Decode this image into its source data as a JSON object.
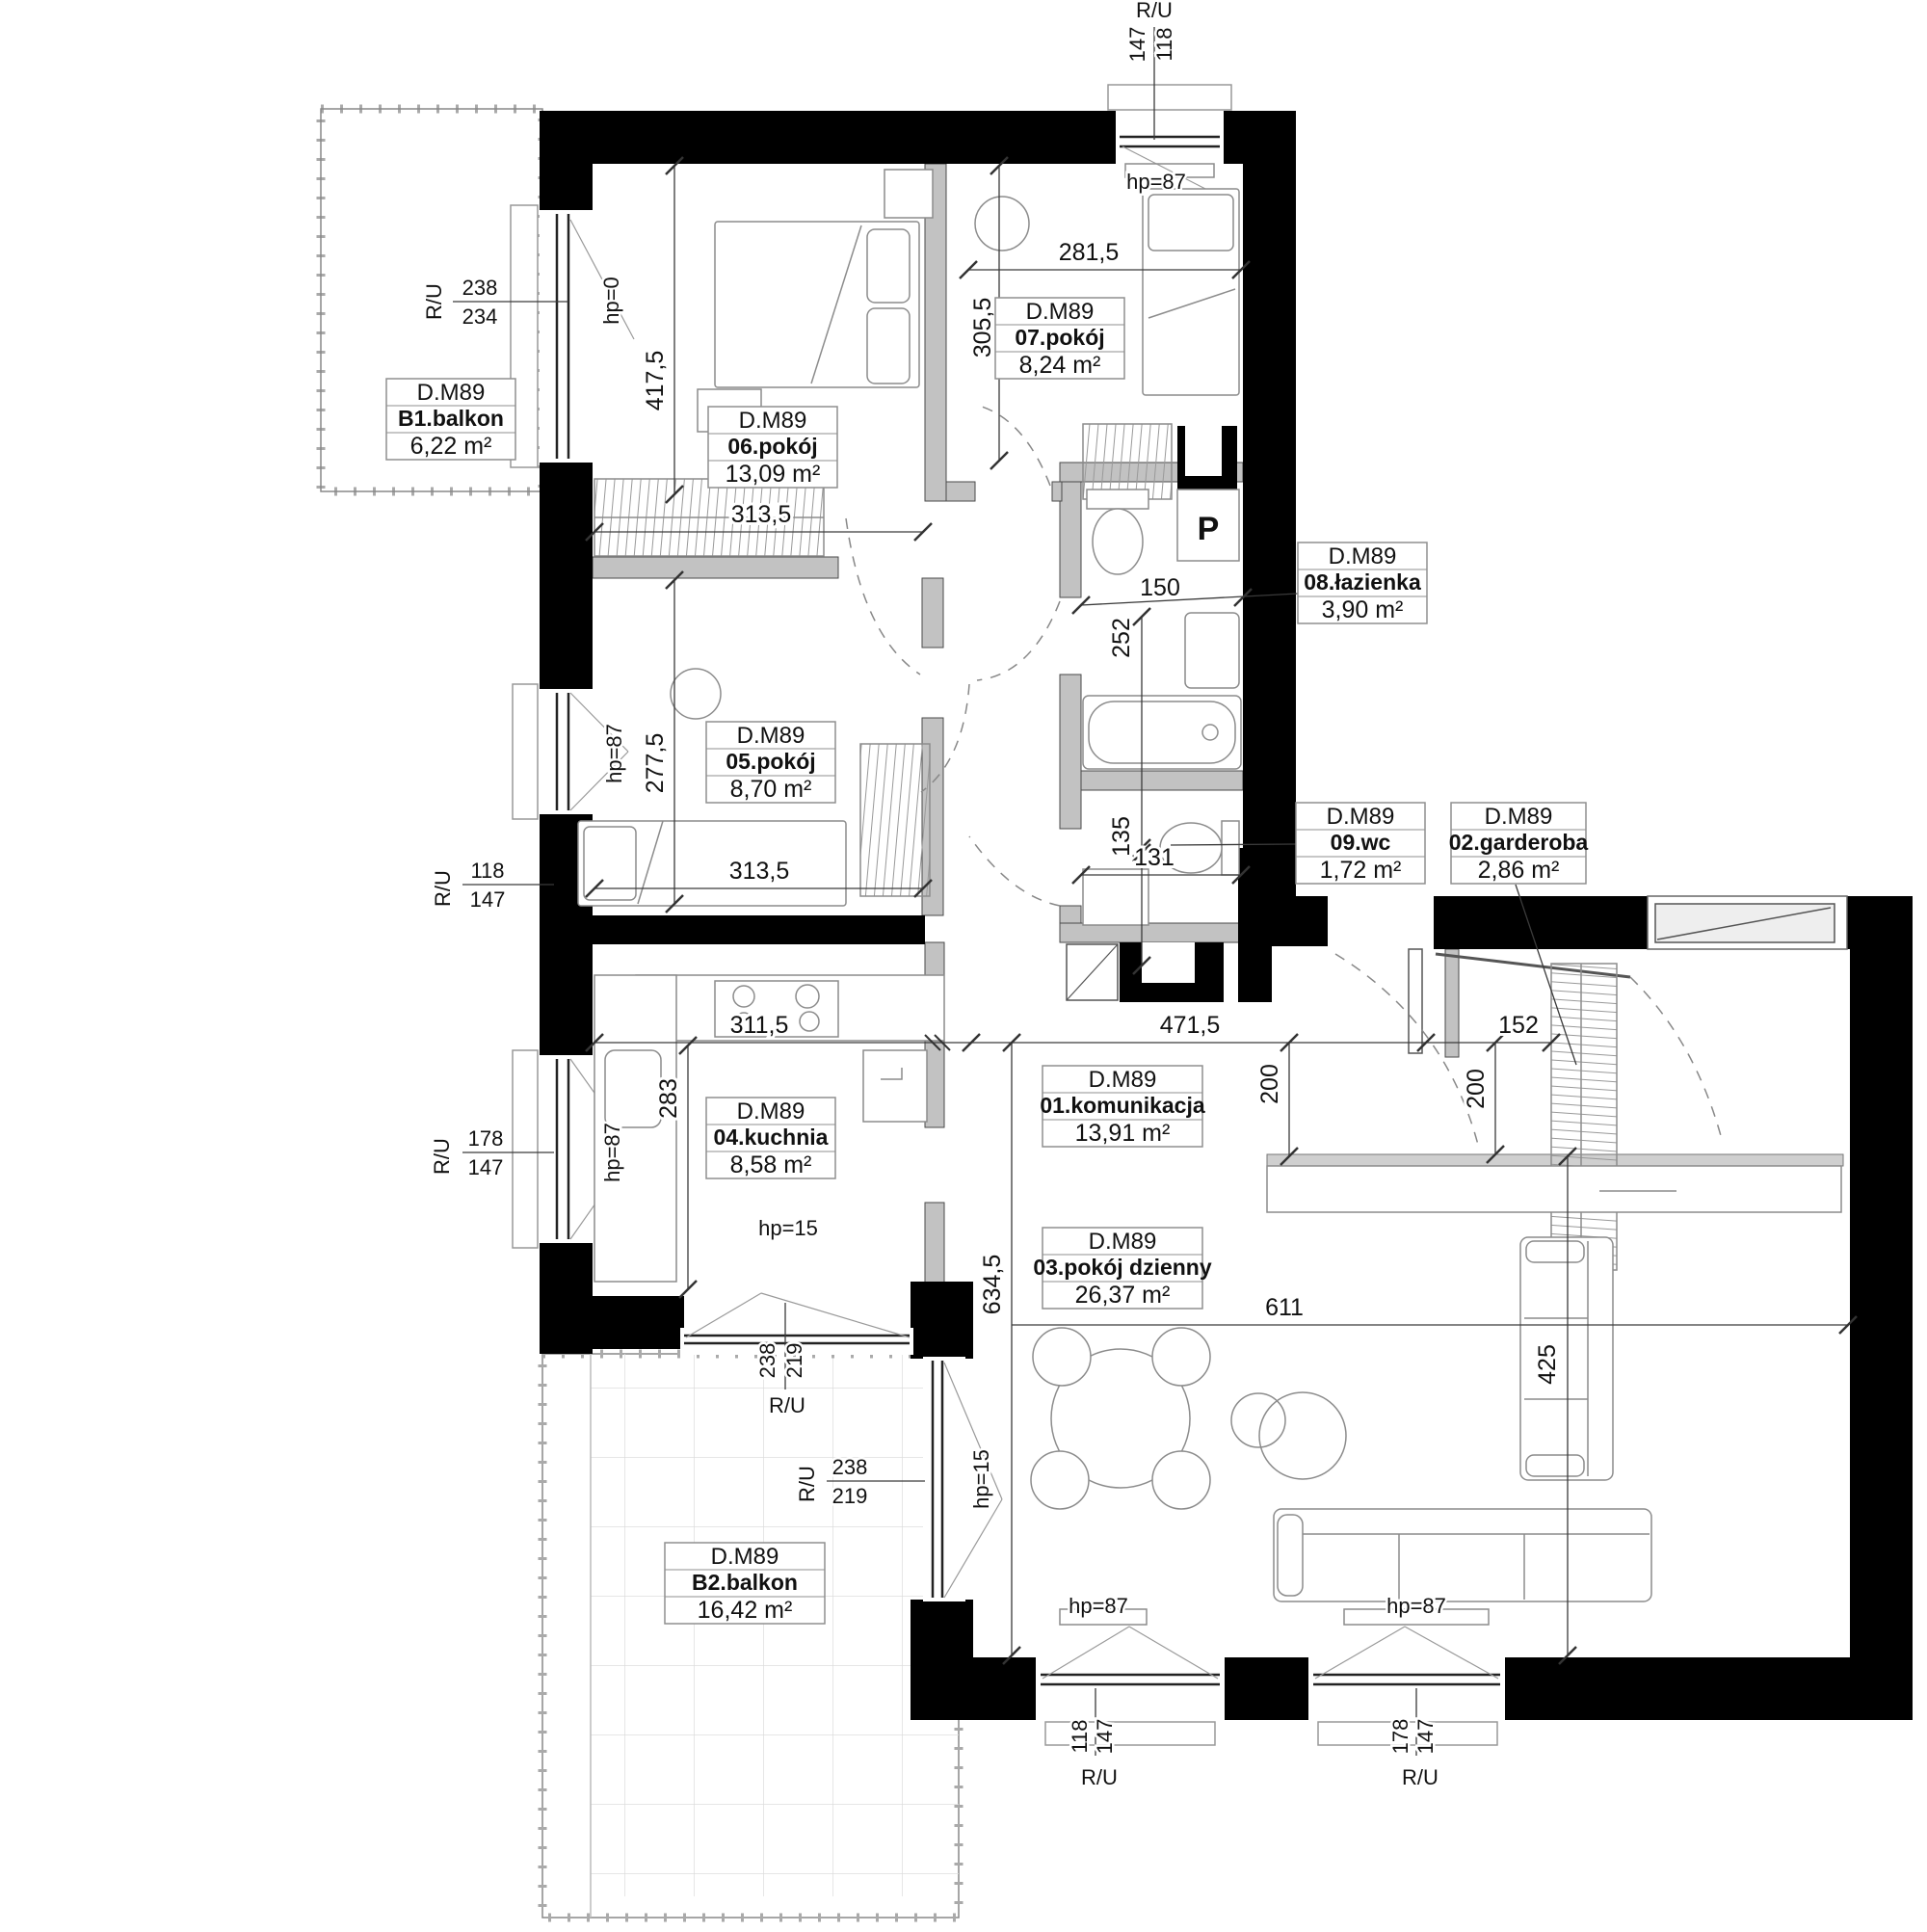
{
  "unit_code": "D.M89",
  "rooms": {
    "komunikacja": {
      "unit": "D.M89",
      "name": "01.komunikacja",
      "area": "13,91 m²"
    },
    "garderoba": {
      "unit": "D.M89",
      "name": "02.garderoba",
      "area": "2,86 m²"
    },
    "pokoj_dzienny": {
      "unit": "D.M89",
      "name": "03.pokój dzienny",
      "area": "26,37 m²"
    },
    "kuchnia": {
      "unit": "D.M89",
      "name": "04.kuchnia",
      "area": "8,58 m²"
    },
    "pokoj05": {
      "unit": "D.M89",
      "name": "05.pokój",
      "area": "8,70 m²"
    },
    "pokoj06": {
      "unit": "D.M89",
      "name": "06.pokój",
      "area": "13,09 m²"
    },
    "pokoj07": {
      "unit": "D.M89",
      "name": "07.pokój",
      "area": "8,24 m²"
    },
    "lazienka": {
      "unit": "D.M89",
      "name": "08.łazienka",
      "area": "3,90 m²"
    },
    "wc": {
      "unit": "D.M89",
      "name": "09.wc",
      "area": "1,72 m²"
    },
    "balkon1": {
      "unit": "D.M89",
      "name": "B1.balkon",
      "area": "6,22 m²"
    },
    "balkon2": {
      "unit": "D.M89",
      "name": "B2.balkon",
      "area": "16,42 m²"
    }
  },
  "dimensions": {
    "w281": "281,5",
    "h305": "305,5",
    "h417": "417,5",
    "w313a": "313,5",
    "w150": "150",
    "h252": "252",
    "h277": "277,5",
    "w313b": "313,5",
    "h135": "135",
    "w131": "131",
    "w311": "311,5",
    "w471": "471,5",
    "w152": "152",
    "h283": "283",
    "h200a": "200",
    "h200b": "200",
    "h634": "634,5",
    "w611": "611",
    "h425": "425"
  },
  "windows": {
    "top": {
      "label": "R/U",
      "num": "147",
      "den": "118",
      "hp": "hp=87"
    },
    "balcony1_door": {
      "label": "R/U",
      "num": "238",
      "den": "234",
      "hp": "hp=0"
    },
    "room05": {
      "label": "R/U",
      "num": "118",
      "den": "147",
      "hp": "hp=87"
    },
    "kitchen": {
      "label": "R/U",
      "num": "178",
      "den": "147",
      "hp": "hp=87"
    },
    "kitchen_low": {
      "hp": "hp=15"
    },
    "balcony2_kitchen": {
      "label": "R/U",
      "num": "238",
      "den": "219"
    },
    "balcony2_door": {
      "label": "R/U",
      "num": "238",
      "den": "219",
      "hp": "hp=15"
    },
    "bottom_left": {
      "label": "R/U",
      "num": "118",
      "den": "147",
      "hp": "hp=87"
    },
    "bottom_right": {
      "label": "R/U",
      "num": "178",
      "den": "147",
      "hp": "hp=87"
    }
  },
  "fixtures": {
    "washer": "P"
  }
}
